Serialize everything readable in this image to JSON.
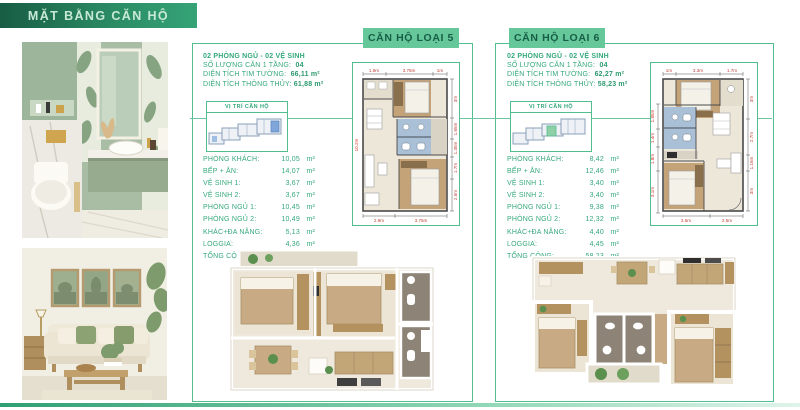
{
  "header": {
    "title": "MẶT BẰNG CĂN HỘ"
  },
  "colors": {
    "header_gradient_dark": "#175c44",
    "header_gradient_light": "#35a377",
    "badge_green": "#66c79b",
    "border_green": "#52bd8f",
    "text_green": "#35a87c",
    "dimension_red": "#c0453a",
    "locator_highlight_type5": "#7ea6d8",
    "locator_highlight_type6": "#8fd0a8"
  },
  "panels": [
    {
      "badge": "CĂN HỘ LOẠI 5",
      "bedrooms_line": "02 PHÒNG NGỦ - 02 VỆ SINH",
      "quantity_label": "SỐ LƯỢNG CĂN 1 TẦNG:",
      "quantity_value": "04",
      "wall_area_label": "DIỆN TÍCH TIM TƯỜNG:",
      "wall_area_value": "66,11 m²",
      "clear_area_label": "DIỆN TÍCH THÔNG THỦY:",
      "clear_area_value": "61,88 m²",
      "locator_title": "VỊ TRÍ CĂN HỘ",
      "rooms": [
        {
          "label": "PHÒNG KHÁCH:",
          "value": "10,05",
          "unit": "m²"
        },
        {
          "label": "BẾP + ĂN:",
          "value": "14,07",
          "unit": "m²"
        },
        {
          "label": "VỆ SINH 1:",
          "value": "3,67",
          "unit": "m²"
        },
        {
          "label": "VỆ SINH 2:",
          "value": "3,67",
          "unit": "m²"
        },
        {
          "label": "PHÒNG NGỦ 1:",
          "value": "10,45",
          "unit": "m²"
        },
        {
          "label": "PHÒNG NGỦ 2:",
          "value": "10,49",
          "unit": "m²"
        },
        {
          "label": "KHÁC+ĐA NĂNG:",
          "value": "5,13",
          "unit": "m²"
        },
        {
          "label": "LOGGIA:",
          "value": "4,36",
          "unit": "m²"
        },
        {
          "label": "TỔNG CỘNG:",
          "value": "61,88",
          "unit": "m²"
        }
      ],
      "plan_dims": {
        "top": [
          "1.9m",
          "3.75m",
          "1m"
        ],
        "bottom": [
          "2.9m",
          "3.75m"
        ],
        "right": [
          "3m",
          "1.65m",
          "1.35m",
          "1.7m",
          "2.5m"
        ],
        "left": [
          "10.2m"
        ]
      }
    },
    {
      "badge": "CĂN HỘ LOẠI 6",
      "bedrooms_line": "02 PHÒNG NGỦ - 02 VỆ SINH",
      "quantity_label": "SỐ LƯỢNG CĂN 1 TẦNG:",
      "quantity_value": "04",
      "wall_area_label": "DIỆN TÍCH TIM TƯỜNG:",
      "wall_area_value": "62,27 m²",
      "clear_area_label": "DIỆN TÍCH THÔNG THỦY:",
      "clear_area_value": "58,23 m²",
      "locator_title": "VỊ TRÍ CĂN HỘ",
      "rooms": [
        {
          "label": "PHÒNG KHÁCH:",
          "value": "8,42",
          "unit": "m²"
        },
        {
          "label": "BẾP + ĂN:",
          "value": "12,46",
          "unit": "m²"
        },
        {
          "label": "VỆ SINH 1:",
          "value": "3,40",
          "unit": "m²"
        },
        {
          "label": "VỆ SINH 2:",
          "value": "3,40",
          "unit": "m²"
        },
        {
          "label": "PHÒNG NGỦ 1:",
          "value": "9,38",
          "unit": "m²"
        },
        {
          "label": "PHÒNG NGỦ 2:",
          "value": "12,32",
          "unit": "m²"
        },
        {
          "label": "KHÁC+ĐA NĂNG:",
          "value": "4,40",
          "unit": "m²"
        },
        {
          "label": "LOGGIA:",
          "value": "4,45",
          "unit": "m²"
        },
        {
          "label": "TỔNG CỘNG:",
          "value": "58,23",
          "unit": "m²"
        }
      ],
      "plan_dims": {
        "top": [
          "1m",
          "3.3m",
          "1.7m"
        ],
        "bottom": [
          "3.5m",
          "2.5m"
        ],
        "right": [
          "3m",
          "2.7m",
          "1.16m",
          "3m"
        ],
        "left": [
          "1.85m",
          "1.4m",
          "1.8m",
          "3.1m"
        ]
      }
    }
  ]
}
